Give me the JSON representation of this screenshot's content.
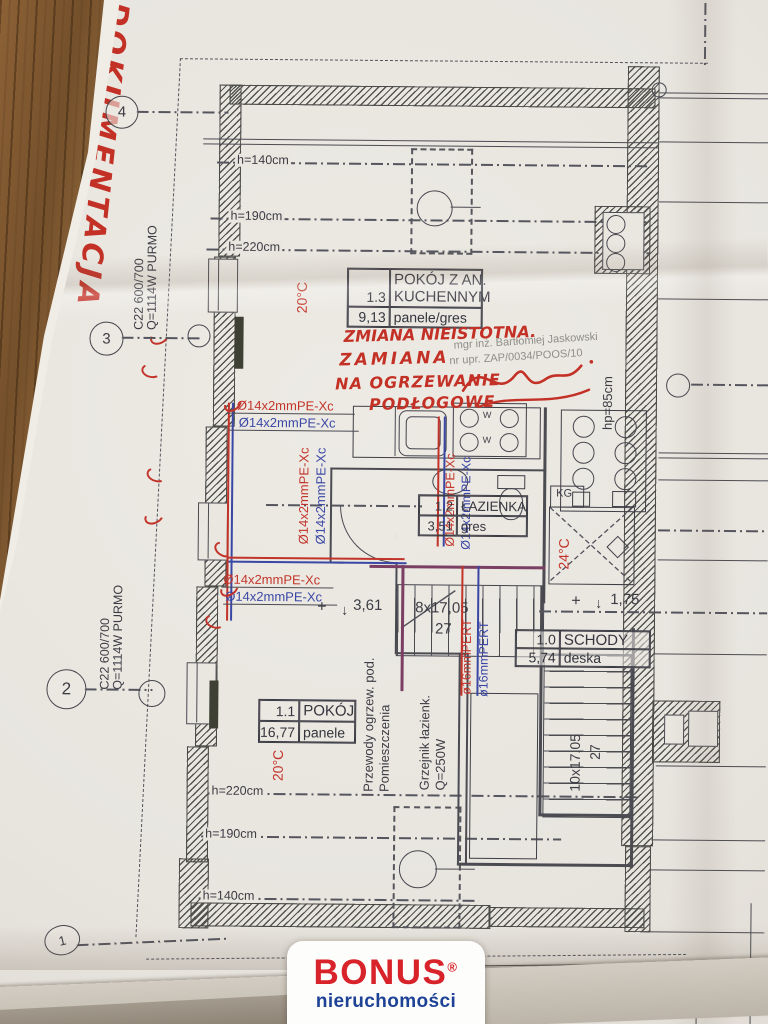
{
  "document": {
    "side_note": "DOKUMENTACJA"
  },
  "axes": {
    "a4": "4",
    "a3": "3",
    "a2": "2",
    "a1": "1"
  },
  "rooms": {
    "r13": {
      "id": "1.3",
      "name_line1": "POKÓJ Z AN.",
      "name_line2": "KUCHENNYM",
      "area": "9,13",
      "finish": "panele/gres"
    },
    "r12": {
      "id": "1.2",
      "name": "ŁAZIENKA",
      "area": "3,51",
      "finish": "gres"
    },
    "r10": {
      "id": "1.0",
      "name": "SCHODY",
      "area": "5,74",
      "finish": "deska"
    },
    "r11": {
      "id": "1.1",
      "name": "POKÓJ",
      "area": "16,77",
      "finish": "panele"
    }
  },
  "heights": {
    "h140": "h=140cm",
    "h190": "h=190cm",
    "h220": "h=220cm",
    "hp85": "hp=85cm"
  },
  "temps": {
    "t20": "20°C",
    "t24": "24°C"
  },
  "radiator": {
    "model": "C22 600/700",
    "power": "Q=1114W PURMO"
  },
  "pipes": {
    "pe_xc": "Ø14x2mmPE-Xc",
    "pert": "ø16mmPERT"
  },
  "stairs": {
    "upper_run": "8x17,05",
    "upper_width": "27",
    "lower_run": "10x17,05",
    "lower_width": "27",
    "plus": "+",
    "down_arrow": "↓",
    "level_upper": "1,75",
    "level_lower": "3,61"
  },
  "notes": {
    "v1": "Przewody ogrzew. pod.",
    "v2": "Pomieszczenia",
    "v3": "Grzejnik łazienk.",
    "v4": "Q=250W",
    "kg": "KG",
    "w": "W"
  },
  "handwriting": {
    "l1": "ZMIANA NIEISTOTNA.",
    "l2": "ZAMIANA",
    "l3": "NA OGRZEWANIE",
    "l4": "PODŁOGOWE"
  },
  "stamp": {
    "l1": "mgr inż. Bartłomiej Jaskowski",
    "l2": "nr upr. ZAP/0034/POOS/10"
  },
  "logo": {
    "brand": "BONUS",
    "registered": "®",
    "subtitle": "nieruchomości",
    "brand_color": "#d8232a",
    "subtitle_color": "#1e4396"
  }
}
